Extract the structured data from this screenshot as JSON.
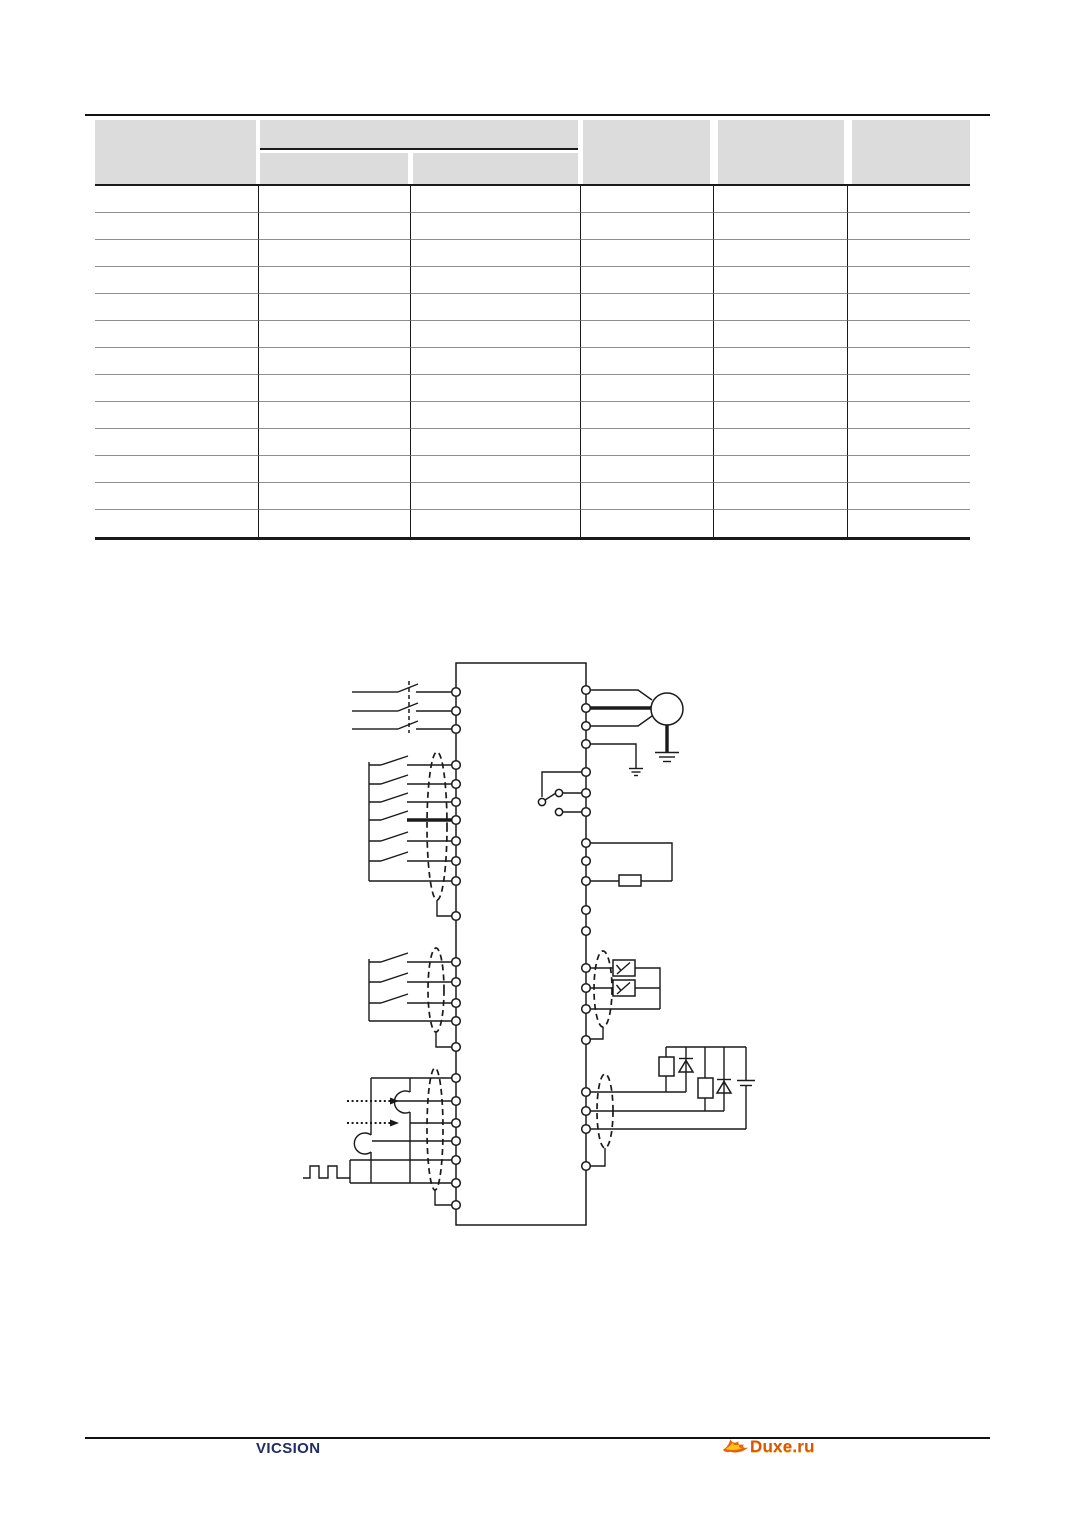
{
  "page": {
    "background": "#ffffff"
  },
  "colors": {
    "line_black": "#1a1a1a",
    "row_divider_gray": "#8f8f8f",
    "header_fill": "#dcdcdc",
    "brand_navy": "#1e2e63",
    "watermark_orange": "#d85703",
    "flame_yellow": "#fcc21c",
    "flame_orange": "#e8610a"
  },
  "table": {
    "column_count": 6,
    "body_row_count": 13,
    "cells_empty": true,
    "header": {
      "col1": "",
      "group": "",
      "sub1": "",
      "sub2": "",
      "col4": "",
      "col5": "",
      "col6": ""
    }
  },
  "diagram": {
    "parts": [
      "inverter-main-box",
      "three-phase-breaker-input",
      "motor-with-ground",
      "protective-earth-ground",
      "spdt-selector-switch",
      "braking-resistor-loop",
      "digital-input-switch-group-1",
      "digital-input-switch-group-2",
      "shielded-cable-ellipses",
      "analog-input-potentiometers",
      "pulse-train-input",
      "analog-output-meters",
      "relay-coils-with-flyback-diodes",
      "dc-supply-symbol"
    ],
    "terminal_count_left": 23,
    "terminal_count_right": 20
  },
  "footer": {
    "brand": "VICSION",
    "watermark": "Duxe.ru"
  }
}
